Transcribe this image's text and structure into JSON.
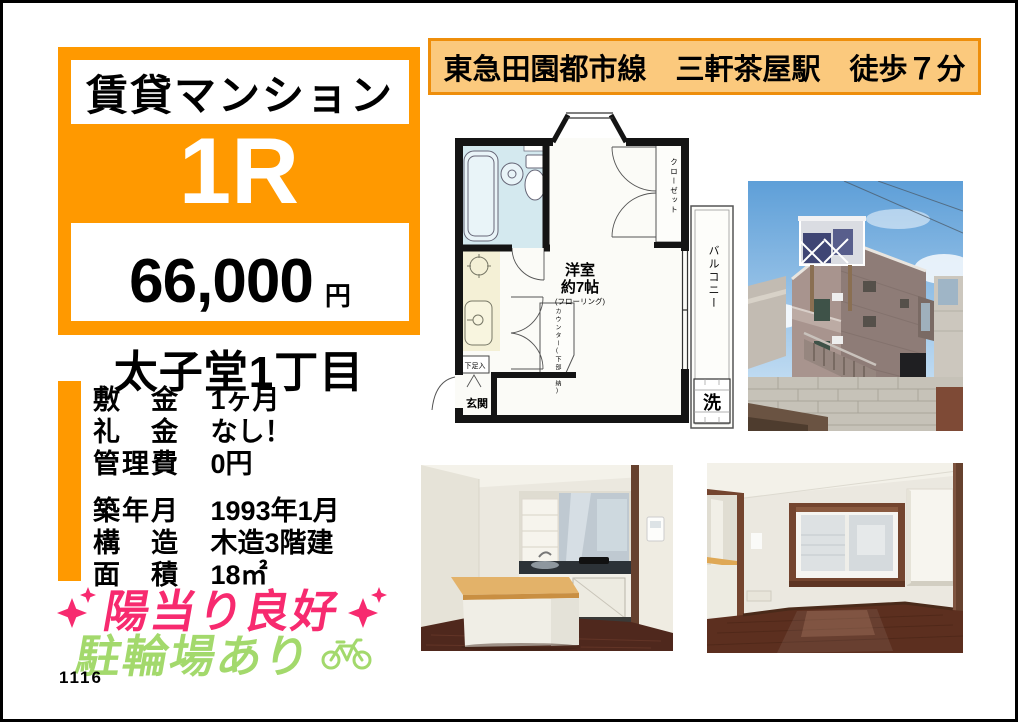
{
  "page": {
    "code": "1116"
  },
  "colors": {
    "accent_orange": "#FF9900",
    "banner_bg": "#FBC97D",
    "banner_border": "#EE8E0B",
    "feature_pink": "#F72A6F",
    "feature_green": "#A3D96C",
    "plan_bath_blue": "#D4E9EF",
    "plan_kitchen_cream": "#F4F0D6"
  },
  "listing": {
    "category": "賃貸マンション",
    "layout": "1R",
    "price_value": "66,000",
    "price_unit": "円",
    "location": "太子堂1丁目"
  },
  "access_banner": "東急田園都市線　三軒茶屋駅　徒歩７分",
  "details": [
    {
      "label": "敷　金",
      "value": "1ヶ月"
    },
    {
      "label": "礼　金",
      "value": "なし！"
    },
    {
      "label": "管理費",
      "value": "0円"
    },
    {
      "label": "築年月",
      "value": "1993年1月"
    },
    {
      "label": "構　造",
      "value": "木造3階建"
    },
    {
      "label": "面　積",
      "value": "18㎡"
    }
  ],
  "features": {
    "sunny": "陽当り良好",
    "bicycle": "駐輪場あり"
  },
  "floorplan": {
    "room": "洋室",
    "room_size": "約7帖",
    "room_note": "(フローリング)",
    "closet": "クローゼット",
    "balcony": "バルコニー",
    "washer": "洗",
    "entrance": "玄関",
    "shoebox": "下足入",
    "counter": "カウンター(下部収納)"
  }
}
